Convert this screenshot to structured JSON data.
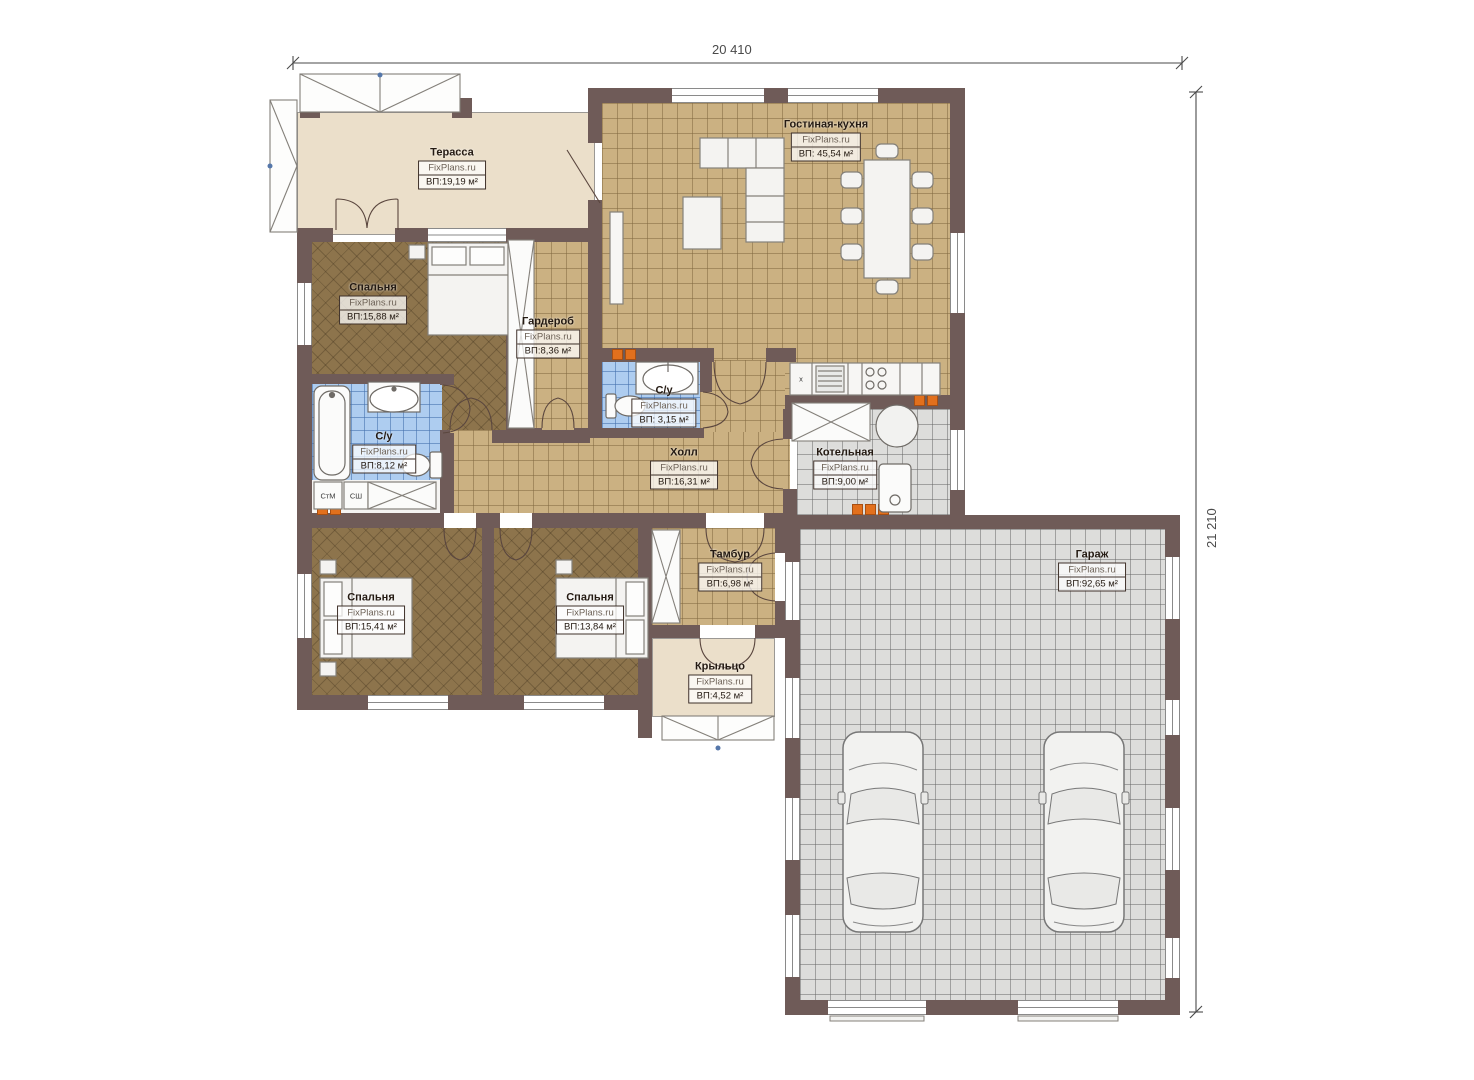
{
  "watermark": "FixPlans.ru",
  "dimensions": {
    "width_label": "20 410",
    "height_label": "21 210"
  },
  "rooms": [
    {
      "key": "terrace",
      "name": "Терасса",
      "area": "ВП:19,19 м²"
    },
    {
      "key": "living_kitchen",
      "name": "Гостиная-кухня",
      "area": "ВП: 45,54 м²"
    },
    {
      "key": "bedroom_1",
      "name": "Спальня",
      "area": "ВП:15,88 м²"
    },
    {
      "key": "wardrobe",
      "name": "Гардероб",
      "area": "ВП:8,36 м²"
    },
    {
      "key": "bathroom_small",
      "name": "С/у",
      "area": "ВП: 3,15 м²"
    },
    {
      "key": "bathroom_main",
      "name": "С/у",
      "area": "ВП:8,12 м²"
    },
    {
      "key": "hall",
      "name": "Холл",
      "area": "ВП:16,31 м²"
    },
    {
      "key": "boiler_room",
      "name": "Котельная",
      "area": "ВП:9,00 м²"
    },
    {
      "key": "tambour",
      "name": "Тамбур",
      "area": "ВП:6,98 м²"
    },
    {
      "key": "garage",
      "name": "Гараж",
      "area": "ВП:92,65 м²"
    },
    {
      "key": "bedroom_2",
      "name": "Спальня",
      "area": "ВП:15,41 м²"
    },
    {
      "key": "bedroom_3",
      "name": "Спальня",
      "area": "ВП:13,84 м²"
    },
    {
      "key": "porch",
      "name": "Крыльцо",
      "area": "ВП:4,52 м²"
    }
  ],
  "equipment_labels": {
    "washing_machine": "СтМ",
    "drying_cabinet": "СШ",
    "kitchen_mark": "х"
  },
  "colors": {
    "wall": "#6f5b58",
    "floor_tile": "#cbb182",
    "floor_bedroom": "#8d744c",
    "floor_bath": "#aecdf0",
    "floor_tech": "#dddddb",
    "floor_terrace": "#ebdfca",
    "radiator": "#e2701d"
  }
}
